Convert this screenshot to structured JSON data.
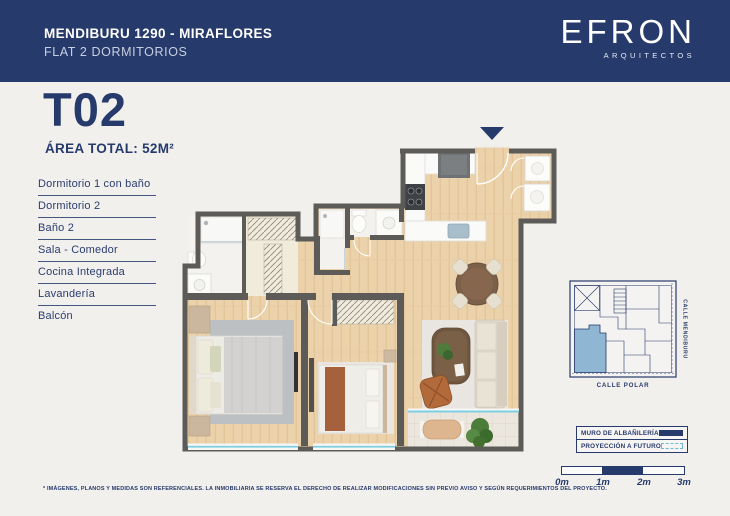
{
  "header": {
    "title": "MENDIBURU 1290 - MIRAFLORES",
    "subtitle": "FLAT 2 DORMITORIOS",
    "brand": "EFRON",
    "brand_sub": "ARQUITECTOS"
  },
  "unit": {
    "code": "T02",
    "area": "ÁREA TOTAL: 52M²"
  },
  "rooms": [
    "Dormitorio 1 con baño",
    "Dormitorio 2",
    "Baño 2",
    "Sala - Comedor",
    "Cocina Integrada",
    "Lavandería",
    "Balcón"
  ],
  "site_map": {
    "street_right": "CALLE MENDIBURU",
    "street_bottom": "CALLE POLAR"
  },
  "legend": {
    "items": [
      {
        "label": "MURO DE ALBAÑILERÍA",
        "swatch": "solid-navy"
      },
      {
        "label": "PROYECCIÓN A FUTURO",
        "swatch": "dashed-cyan"
      }
    ]
  },
  "scale_bar": {
    "labels": [
      "0m",
      "1m",
      "2m",
      "3m"
    ]
  },
  "disclaimer": "* IMÁGENES, PLANOS Y MEDIDAS SON REFERENCIALES. LA INMOBILIARIA SE RESERVA EL DERECHO DE REALIZAR MODIFICACIONES SIN PREVIO AVISO Y SEGÚN REQUERIMIENTOS DEL PROYECTO.",
  "colors": {
    "navy": "#263A6B",
    "background": "#F1F0ED",
    "wall_gray": "#5D5B58",
    "wood": "#ECD2AB",
    "glass_blue": "#7FCFE3",
    "map_highlight": "#8FB6D2"
  }
}
